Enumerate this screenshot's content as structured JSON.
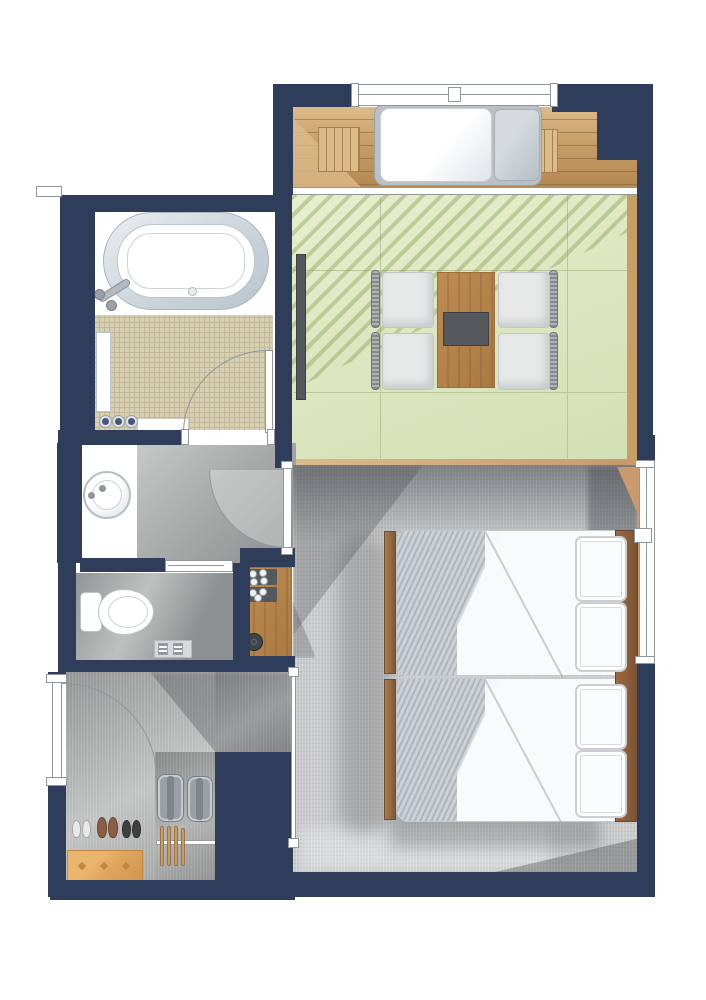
{
  "meta": {
    "kind": "hand-rendered hotel guest room floor plan, top-down view",
    "orientation": "entrance lower-left, balcony top, bedroom lower-right"
  },
  "palette": {
    "navy": "#2e3d59",
    "line": "#8f969c",
    "deck": "#c79d68",
    "deckLight": "#dcbb8b",
    "deckDark": "#b48852",
    "deckLine": "#a57f4f",
    "green": "#dfe7c2",
    "greenLine": "#b9c79b",
    "greenHatch": "rgba(134,162,84,0.42)",
    "tile": "#d8d0b5",
    "tileLine": "#c4b996",
    "carpetHall": "#a9acab",
    "carpetBed": "#c7c9ca",
    "stone": "#b2b4b3",
    "fixLine": "#b9c2c8",
    "woodMid": "#bf8c52",
    "woodGrain": "#9b6e3b",
    "woodHead": "#8a5f3a",
    "woodSill": "#c89a6e",
    "tray": "#55595e",
    "cushion": "#e7e9e9",
    "cushionLine": "#c2c6c7",
    "frameGray": "#b9c1c7",
    "mattress": "#f6f8f9",
    "duvet": "#ccd2d6",
    "benchOrange": "#dfa45c",
    "benchLine": "#c08845",
    "luggage": "#9aa1a6",
    "kettle": "#3f444a",
    "bottle": "#46557a",
    "shoeBrown": "#8a5f45",
    "shoeBlack": "#3f3f41",
    "shoeWhite": "#e9e9e7",
    "tv": "#53585e"
  },
  "rooms": [
    {
      "id": "balcony-deck",
      "floor": "wood planks",
      "furniture": [
        "day-bed-lounger",
        "backrest-cushion",
        "slat-bench-left",
        "slat-bench-right",
        "railing-with-center-post"
      ]
    },
    {
      "id": "living-area",
      "floor": "light green tile with diagonal light hatch",
      "furniture": [
        "wood-dining-table",
        "dark-serving-tray"
      ],
      "chair_count": 4,
      "extras": [
        "wall-mounted-tv-panel",
        "glass-door-track-to-deck"
      ]
    },
    {
      "id": "bathroom",
      "floor": "white + beige mosaic tile",
      "furniture": [
        "oval-bathtub",
        "shower-mixer-and-wand",
        "wall-bench",
        "bath-mat"
      ],
      "toiletry_bottle_count": 3,
      "door": "swing door, hinge lower-right"
    },
    {
      "id": "vanity-nook",
      "furniture": [
        "round-basin",
        "faucet"
      ],
      "counter": "white"
    },
    {
      "id": "toilet-room",
      "furniture": [
        "toilet-with-tank",
        "paper-shelf"
      ],
      "paper_roll_count": 2,
      "door": "sliding door on top wall"
    },
    {
      "id": "hallway",
      "floor": "gray carpet",
      "door": "swing door to bedroom, hinge upper-right"
    },
    {
      "id": "minibar-counter",
      "items": [
        "cup-tray-upper",
        "cup-tray-lower",
        "kettle"
      ],
      "cup_count": 7
    },
    {
      "id": "bedroom",
      "floor": "light gray carpet",
      "bed_count": 2,
      "pillow_count": 4,
      "furniture": [
        "twin-bed-upper",
        "twin-bed-lower",
        "wood-footboards",
        "wood-headboard-panel",
        "corner-shelf"
      ],
      "window": "right wall glazing with center mullion"
    },
    {
      "id": "entryway",
      "floor": "gray stone",
      "furniture": [
        "entrance-swing-door",
        "shoe-bench-orange"
      ],
      "shoe_pair_count": 3,
      "suitcase_count": 2,
      "hanger_count": 4,
      "extras": [
        "hanger-rail",
        "sliding-partition-to-bedroom"
      ]
    }
  ]
}
